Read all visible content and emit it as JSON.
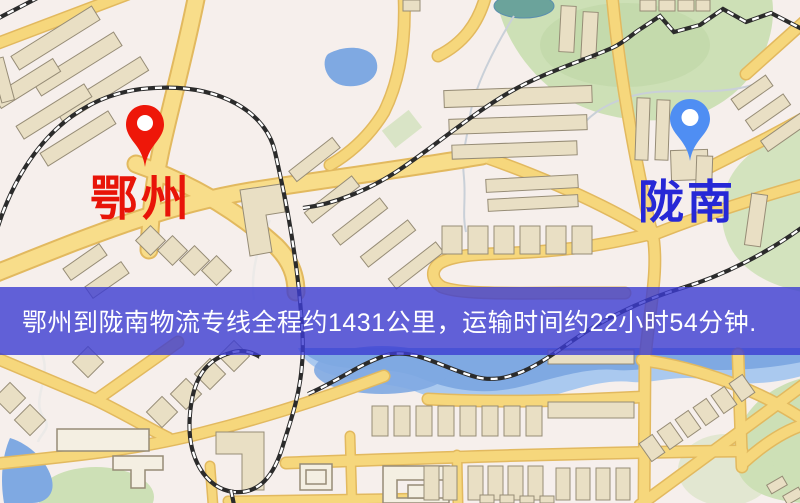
{
  "route": {
    "origin_label": "鄂州",
    "destination_label": "陇南",
    "distance_text": "约1431公里",
    "duration_text": "约22小时54分钟"
  },
  "banner": {
    "text": "鄂州到陇南物流专线全程约1431公里，运输时间约22小时54分钟."
  },
  "markers": {
    "origin": {
      "color": "#ee1709",
      "label_color": "#e81408"
    },
    "destination": {
      "color": "#4f8ef3",
      "label_color": "#2628d6"
    }
  },
  "map_colors": {
    "map_bg": "#f6efec",
    "road_fill": "#f6d77c",
    "road_arterial": "#f8dd8a",
    "road_casing": "#e2b95f",
    "building": "#e9dfc4",
    "building_outline": "#968c76",
    "green": "#cde0b6",
    "green_dark": "#bdd6a4",
    "pond": "#6ba39b",
    "water": "#7fa9e2",
    "water_light": "#aac9ef",
    "railway": "#2b2b2b",
    "path_gray": "#c9d0d8",
    "banner_overlay": "rgba(60,60,210,0.8)",
    "banner_text": "#ffffff"
  }
}
